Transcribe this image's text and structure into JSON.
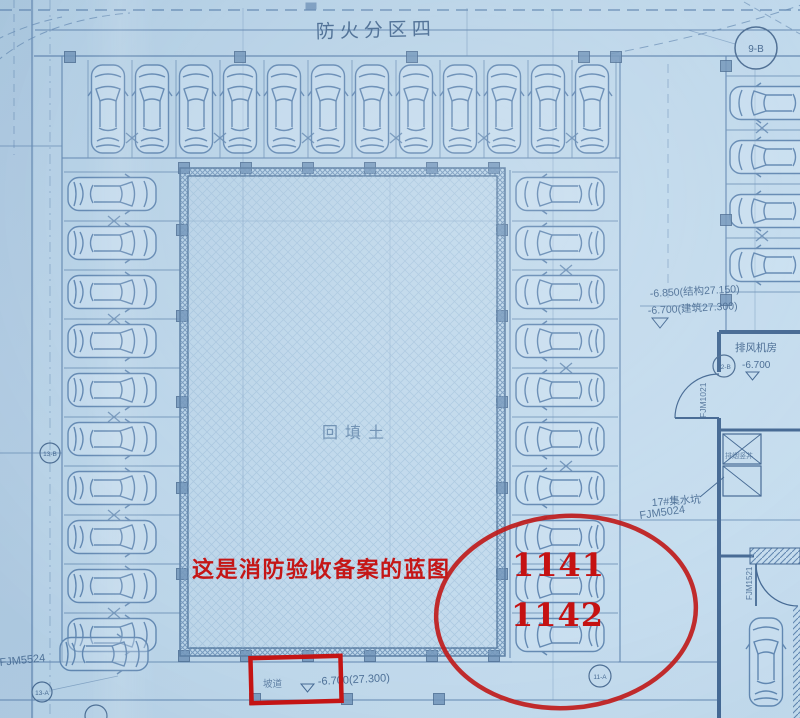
{
  "drawing": {
    "fire_zone_title": "防火分区四",
    "backfill_label": "回填土",
    "ramp_label": "坡道",
    "bottom_level": "-6.700(27.300)",
    "level_structural": "-6.850(结构27.150)",
    "level_architectural": "-6.700(建筑27.300)",
    "fan_room_label": "排风机房",
    "fan_room_level": "-6.700",
    "shaft_label": "排烟竖井",
    "sump_label": "17#集水坑",
    "door_codes": {
      "fjm1021": "FJM1021",
      "fjm1521": "FJM1521",
      "fjm5024": "FJM5024",
      "fjm5524": "FJM5524"
    },
    "grid_bubbles": {
      "top_right": "9-B",
      "left_mid": "13-B",
      "bottom_left": "13-A",
      "fan_room": "12-B",
      "bottom_center": "11-A"
    }
  },
  "annotations": {
    "note": "这是消防验收备案的蓝图",
    "number_top": "1141",
    "number_bottom": "1142"
  },
  "colors": {
    "paper": "#b9d4e8",
    "ink": "#4a6f9d",
    "red": "#c41818"
  }
}
